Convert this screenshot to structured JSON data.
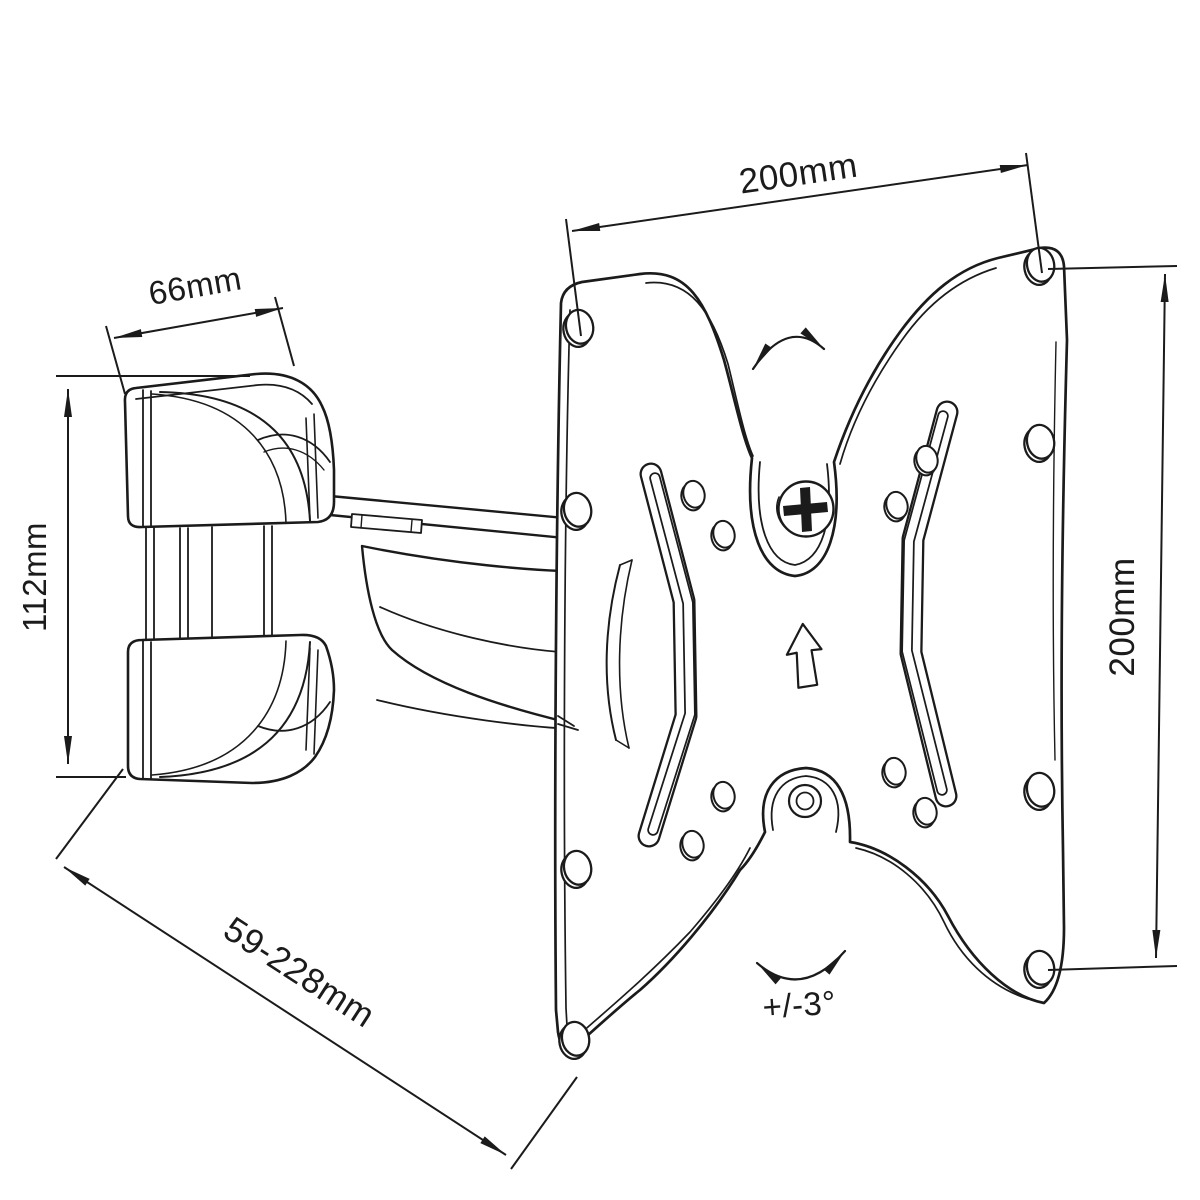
{
  "diagram": {
    "background": "#ffffff",
    "line_color": "#1b1b1b",
    "dimensions": {
      "plate_width": "200mm",
      "plate_height": "200mm",
      "bracket_width": "66mm",
      "bracket_height": "112mm",
      "arm_extension": "59-228mm",
      "tilt_range": "+/-3°"
    }
  }
}
